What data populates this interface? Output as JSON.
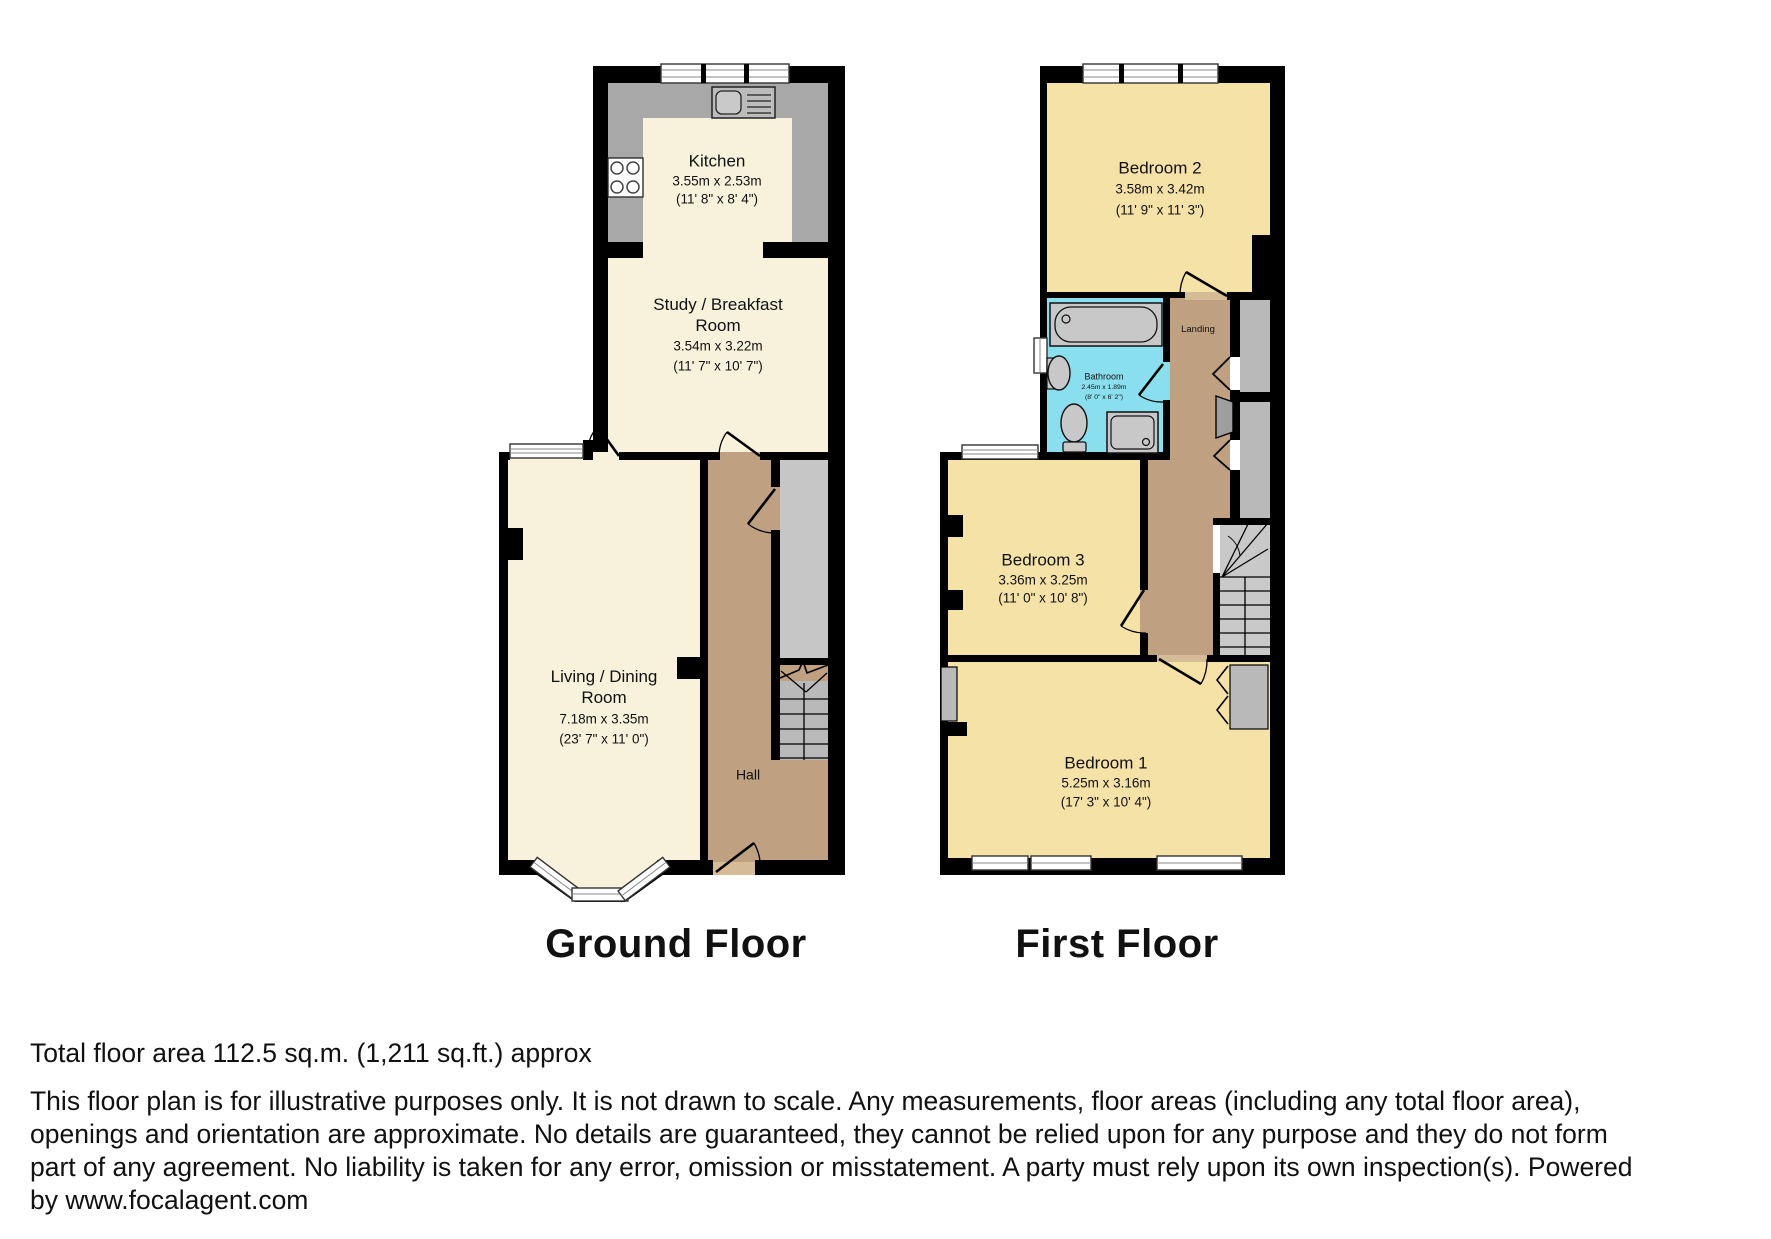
{
  "ground": {
    "title": "Ground Floor",
    "rooms": {
      "kitchen": {
        "name": "Kitchen",
        "metric": "3.55m x 2.53m",
        "imperial": "(11' 8\" x 8' 4\")"
      },
      "study": {
        "name": "Study / Breakfast Room",
        "metric": "3.54m x 3.22m",
        "imperial": "(11' 7\" x 10' 7\")"
      },
      "living": {
        "name": "Living / Dining Room",
        "metric": "7.18m x 3.35m",
        "imperial": "(23' 7\" x 11' 0\")"
      },
      "hall": {
        "name": "Hall"
      }
    }
  },
  "first": {
    "title": "First Floor",
    "rooms": {
      "bedroom2": {
        "name": "Bedroom 2",
        "metric": "3.58m x 3.42m",
        "imperial": "(11' 9\" x 11' 3\")"
      },
      "bathroom": {
        "name": "Bathroom",
        "metric": "2.45m x 1.89m",
        "imperial": "(8' 0\" x 6' 2\")"
      },
      "landing": {
        "name": "Landing"
      },
      "bedroom3": {
        "name": "Bedroom 3",
        "metric": "3.36m x 3.25m",
        "imperial": "(11' 0\" x 10' 8\")"
      },
      "bedroom1": {
        "name": "Bedroom 1",
        "metric": "5.25m x 3.16m",
        "imperial": "(17' 3\" x 10' 4\")"
      }
    }
  },
  "footer": {
    "total_area": "Total floor area 112.5 sq.m. (1,211 sq.ft.) approx",
    "disclaimer_lines": [
      "This floor plan is for illustrative purposes only. It is not drawn to scale. Any measurements, floor areas (including any total floor area),",
      "openings and orientation are approximate. No details are guaranteed, they cannot be relied upon for any purpose and they do not form",
      "part of any agreement. No liability is taken for any error, omission or misstatement. A party must rely upon its own inspection(s). Powered",
      "by www.focalagent.com"
    ]
  },
  "colors": {
    "wall": "#000000",
    "ground_room": "#f8f1dc",
    "first_room": "#f5e2a7",
    "hall_tan": "#bfa080",
    "door_sill": "#d6bb97",
    "kitchen_floor": "#a8a8a8",
    "bathroom": "#8adfee",
    "stair_gray": "#c6c6c6",
    "fixture_gray": "#c8c8c8"
  }
}
